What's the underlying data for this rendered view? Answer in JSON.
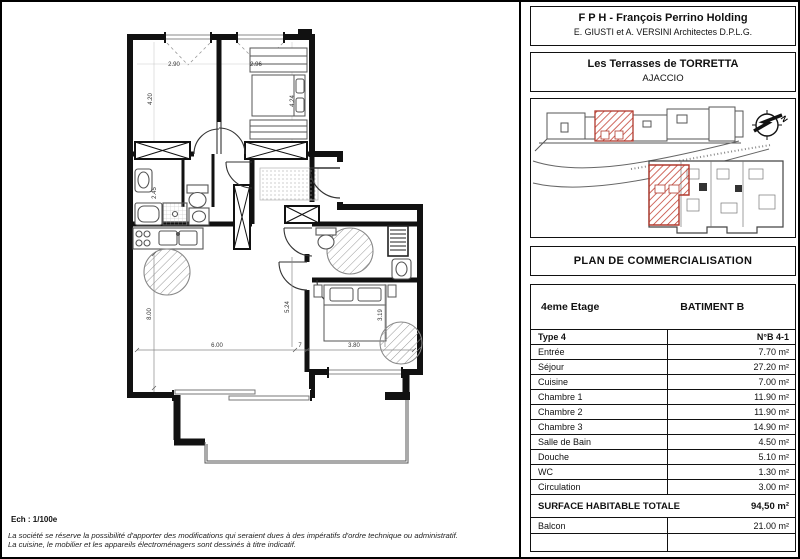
{
  "header": {
    "title": "F P H - François Perrino Holding",
    "architects": "E. GIUSTI et A. VERSINI Architectes D.P.L.G."
  },
  "project": {
    "name": "Les Terrasses de TORRETTA",
    "city": "AJACCIO"
  },
  "site_plan": {
    "north_label": "N",
    "highlight_color": "#c0392b"
  },
  "title_block": {
    "title": "PLAN DE COMMERCIALISATION"
  },
  "table": {
    "floor_label": "4eme Etage",
    "building_label": "BATIMENT B",
    "type_label": "Type 4",
    "unit_label": "N°B 4-1",
    "rows": [
      {
        "label": "Entrée",
        "value": "7.70 m²"
      },
      {
        "label": "Séjour",
        "value": "27.20 m²"
      },
      {
        "label": "Cuisine",
        "value": "7.00 m²"
      },
      {
        "label": "Chambre 1",
        "value": "11.90 m²"
      },
      {
        "label": "Chambre 2",
        "value": "11.90 m²"
      },
      {
        "label": "Chambre 3",
        "value": "14.90 m²"
      },
      {
        "label": "Salle de Bain",
        "value": "4.50 m²"
      },
      {
        "label": "Douche",
        "value": "5.10 m²"
      },
      {
        "label": "WC",
        "value": "1.30 m²"
      },
      {
        "label": "Circulation",
        "value": "3.00 m²"
      }
    ],
    "total_label": "SURFACE HABITABLE TOTALE",
    "total_value": "94,50 m²",
    "balcony": {
      "label": "Balcon",
      "value": "21.00 m²"
    }
  },
  "plan": {
    "scale_label": "Ech : 1/100e",
    "dims": {
      "ch1_w": "2.90",
      "ch2_w": "2.96",
      "ch1_h": "4.20",
      "ch2_h": "4.24",
      "bath": "2.45",
      "liv_w": "6.00",
      "mid": "7",
      "ch3_w": "3.80",
      "liv_h": "8.00",
      "hall_h": "5.24",
      "ch3_h": "3.19"
    }
  },
  "footer": {
    "disclaimer_line1": "La société se réserve la possibilité d'apporter des modifications qui seraient dues à des impératifs d'ordre technique ou administratif.",
    "disclaimer_line2": "La cuisine, le mobilier et les appareils électroménagers sont dessinés à titre indicatif."
  }
}
